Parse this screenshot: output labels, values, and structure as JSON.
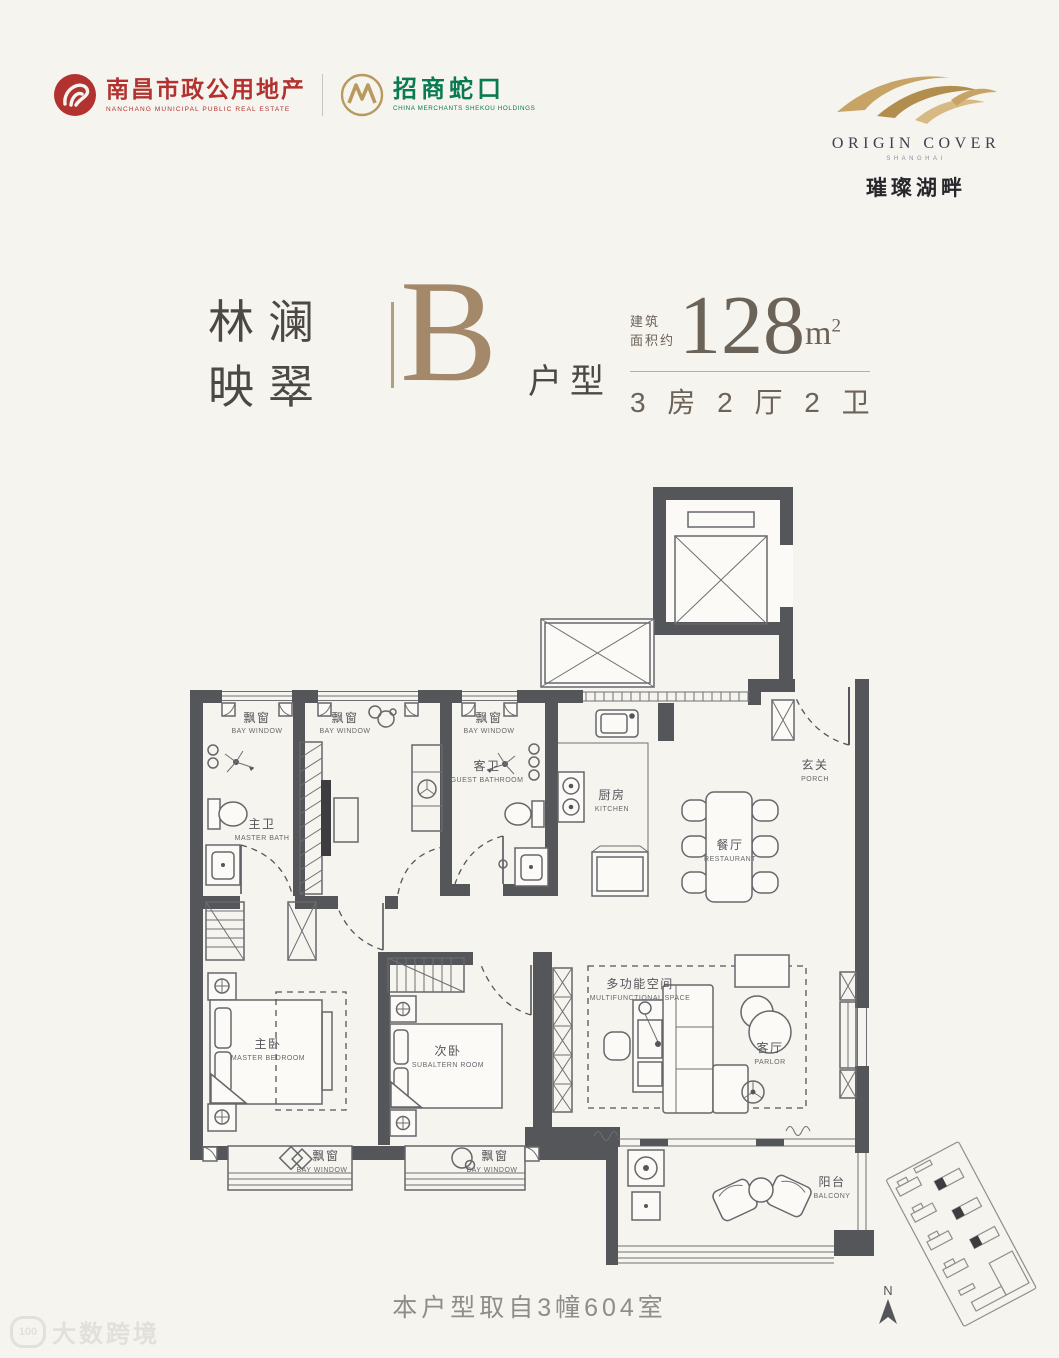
{
  "header": {
    "brand_left": {
      "org1_zh": "南昌市政公用地产",
      "org1_en": "NANCHANG MUNICIPAL PUBLIC REAL ESTATE",
      "org2_zh": "招商蛇口",
      "org2_en": "CHINA MERCHANTS SHEKOU HOLDINGS"
    },
    "brand_right": {
      "name": "ORIGIN COVER",
      "sub": "SHANGHAI",
      "zh": "璀璨湖畔"
    }
  },
  "title": {
    "project_line1": "林澜",
    "project_line2": "映翠",
    "unit_letter": "B",
    "unit_suffix": "户型",
    "area_label_line1": "建筑",
    "area_label_line2": "面积约",
    "area_value": "128",
    "area_unit": "m",
    "area_exponent": "2",
    "rooms_summary": "3 房 2 厅 2 卫"
  },
  "floorplan": {
    "rooms": {
      "bay_top_1": {
        "zh": "飘窗",
        "en": "BAY WINDOW"
      },
      "bay_top_2": {
        "zh": "飘窗",
        "en": "BAY WINDOW"
      },
      "bay_top_3": {
        "zh": "飘窗",
        "en": "BAY WINDOW"
      },
      "master_bath": {
        "zh": "主卫",
        "en": "MASTER BATH"
      },
      "guest_bath": {
        "zh": "客卫",
        "en": "GUEST BATHROOM"
      },
      "kitchen": {
        "zh": "厨房",
        "en": "KITCHEN"
      },
      "porch": {
        "zh": "玄关",
        "en": "PORCH"
      },
      "restaurant": {
        "zh": "餐厅",
        "en": "RESTAURANT"
      },
      "multifunctional": {
        "zh": "多功能空间",
        "en": "MULTIFUNCTIONAL SPACE"
      },
      "parlor": {
        "zh": "客厅",
        "en": "PARLOR"
      },
      "master_bedroom": {
        "zh": "主卧",
        "en": "MASTER BEDROOM"
      },
      "subaltern_room": {
        "zh": "次卧",
        "en": "SUBALTERN ROOM"
      },
      "bay_bottom_1": {
        "zh": "飘窗",
        "en": "BAY WINDOW"
      },
      "bay_bottom_2": {
        "zh": "飘窗",
        "en": "BAY WINDOW"
      },
      "balcony": {
        "zh": "阳台",
        "en": "BALCONY"
      }
    },
    "compass_label": "N",
    "note": "本户型取自3幢604室"
  },
  "watermark": {
    "logo": "100",
    "text": "大数跨境"
  },
  "colors": {
    "background": "#f6f4ef",
    "wall": "#55565a",
    "accent_bronze": "#a3886a",
    "brand_red": "#b23230",
    "brand_green": "#0a7a52",
    "brand_gold": "#b99a5e"
  }
}
